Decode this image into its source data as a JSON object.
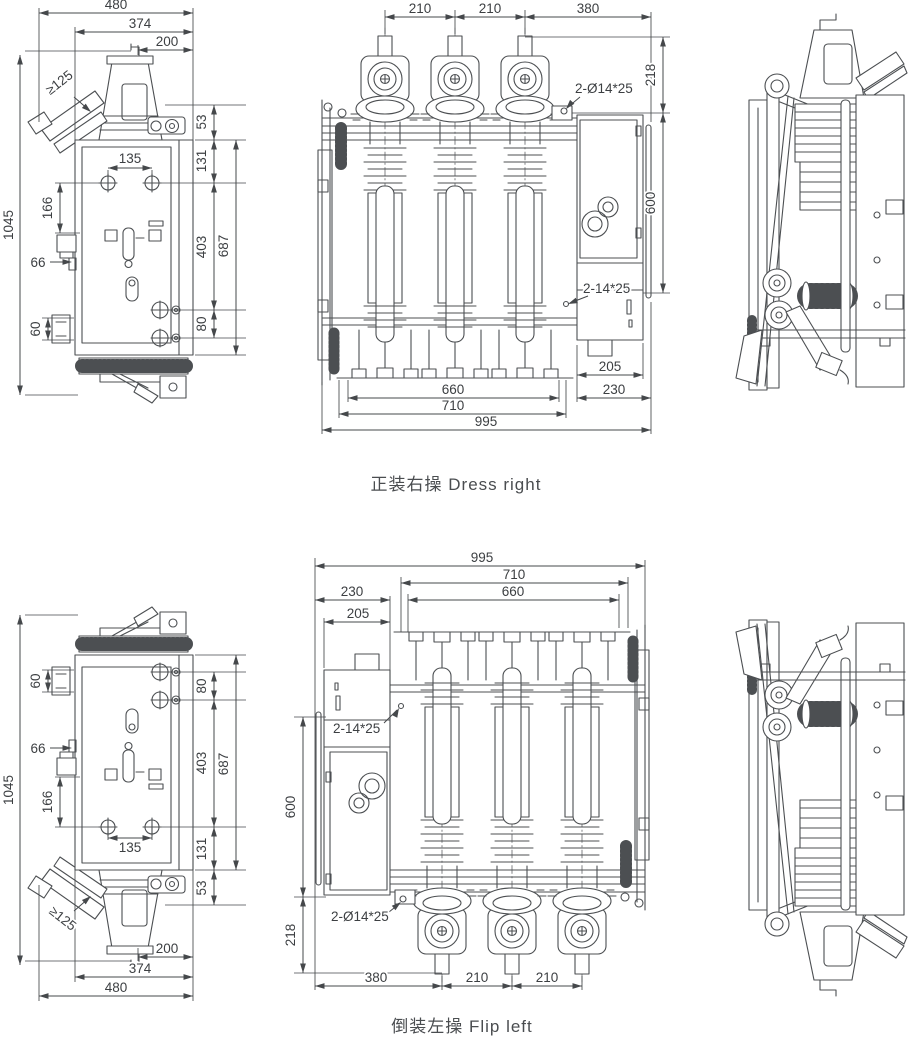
{
  "colors": {
    "line": "#4c4f52",
    "dim": "#45484b",
    "text": "#3c3f42",
    "caption": "#4a4d50",
    "background": "#ffffff"
  },
  "captions": {
    "top": "正装右操 Dress right",
    "bottom": "倒装左操 Flip left"
  },
  "top_view": {
    "side": {
      "overall_width": "480",
      "frame_width": "374",
      "handle_offset": "200",
      "min_clearance": "≥125",
      "top_gap": "53",
      "hole_pitch": "135",
      "top_offset": "131",
      "lever_offset": "166",
      "tab_offset": "66",
      "mid_height": "403",
      "body_height": "687",
      "overall_height": "1045",
      "bracket_height": "60",
      "hole_offset": "80"
    },
    "front": {
      "pitch_left": "210",
      "pitch_right": "210",
      "box_span": "380",
      "bushing_height": "218",
      "top_holes": "2-Ø14*25",
      "body_height": "600",
      "side_holes": "2-14*25",
      "offset_a": "205",
      "offset_b": "230",
      "base_span": "660",
      "frame_span": "710",
      "overall_width": "995"
    }
  },
  "bottom_view": {
    "side": {
      "overall_width": "480",
      "frame_width": "374",
      "handle_offset": "200",
      "min_clearance": "≥125",
      "top_gap": "53",
      "hole_pitch": "135",
      "top_offset": "131",
      "lever_offset": "166",
      "tab_offset": "66",
      "mid_height": "403",
      "body_height": "687",
      "overall_height": "1045",
      "bracket_height": "60",
      "hole_offset": "80"
    },
    "front": {
      "pitch_left": "210",
      "pitch_right": "210",
      "box_span": "380",
      "bushing_height": "218",
      "top_holes": "2-Ø14*25",
      "body_height": "600",
      "side_holes": "2-14*25",
      "offset_a": "205",
      "offset_b": "230",
      "base_span": "660",
      "frame_span": "710",
      "overall_width": "995"
    }
  }
}
